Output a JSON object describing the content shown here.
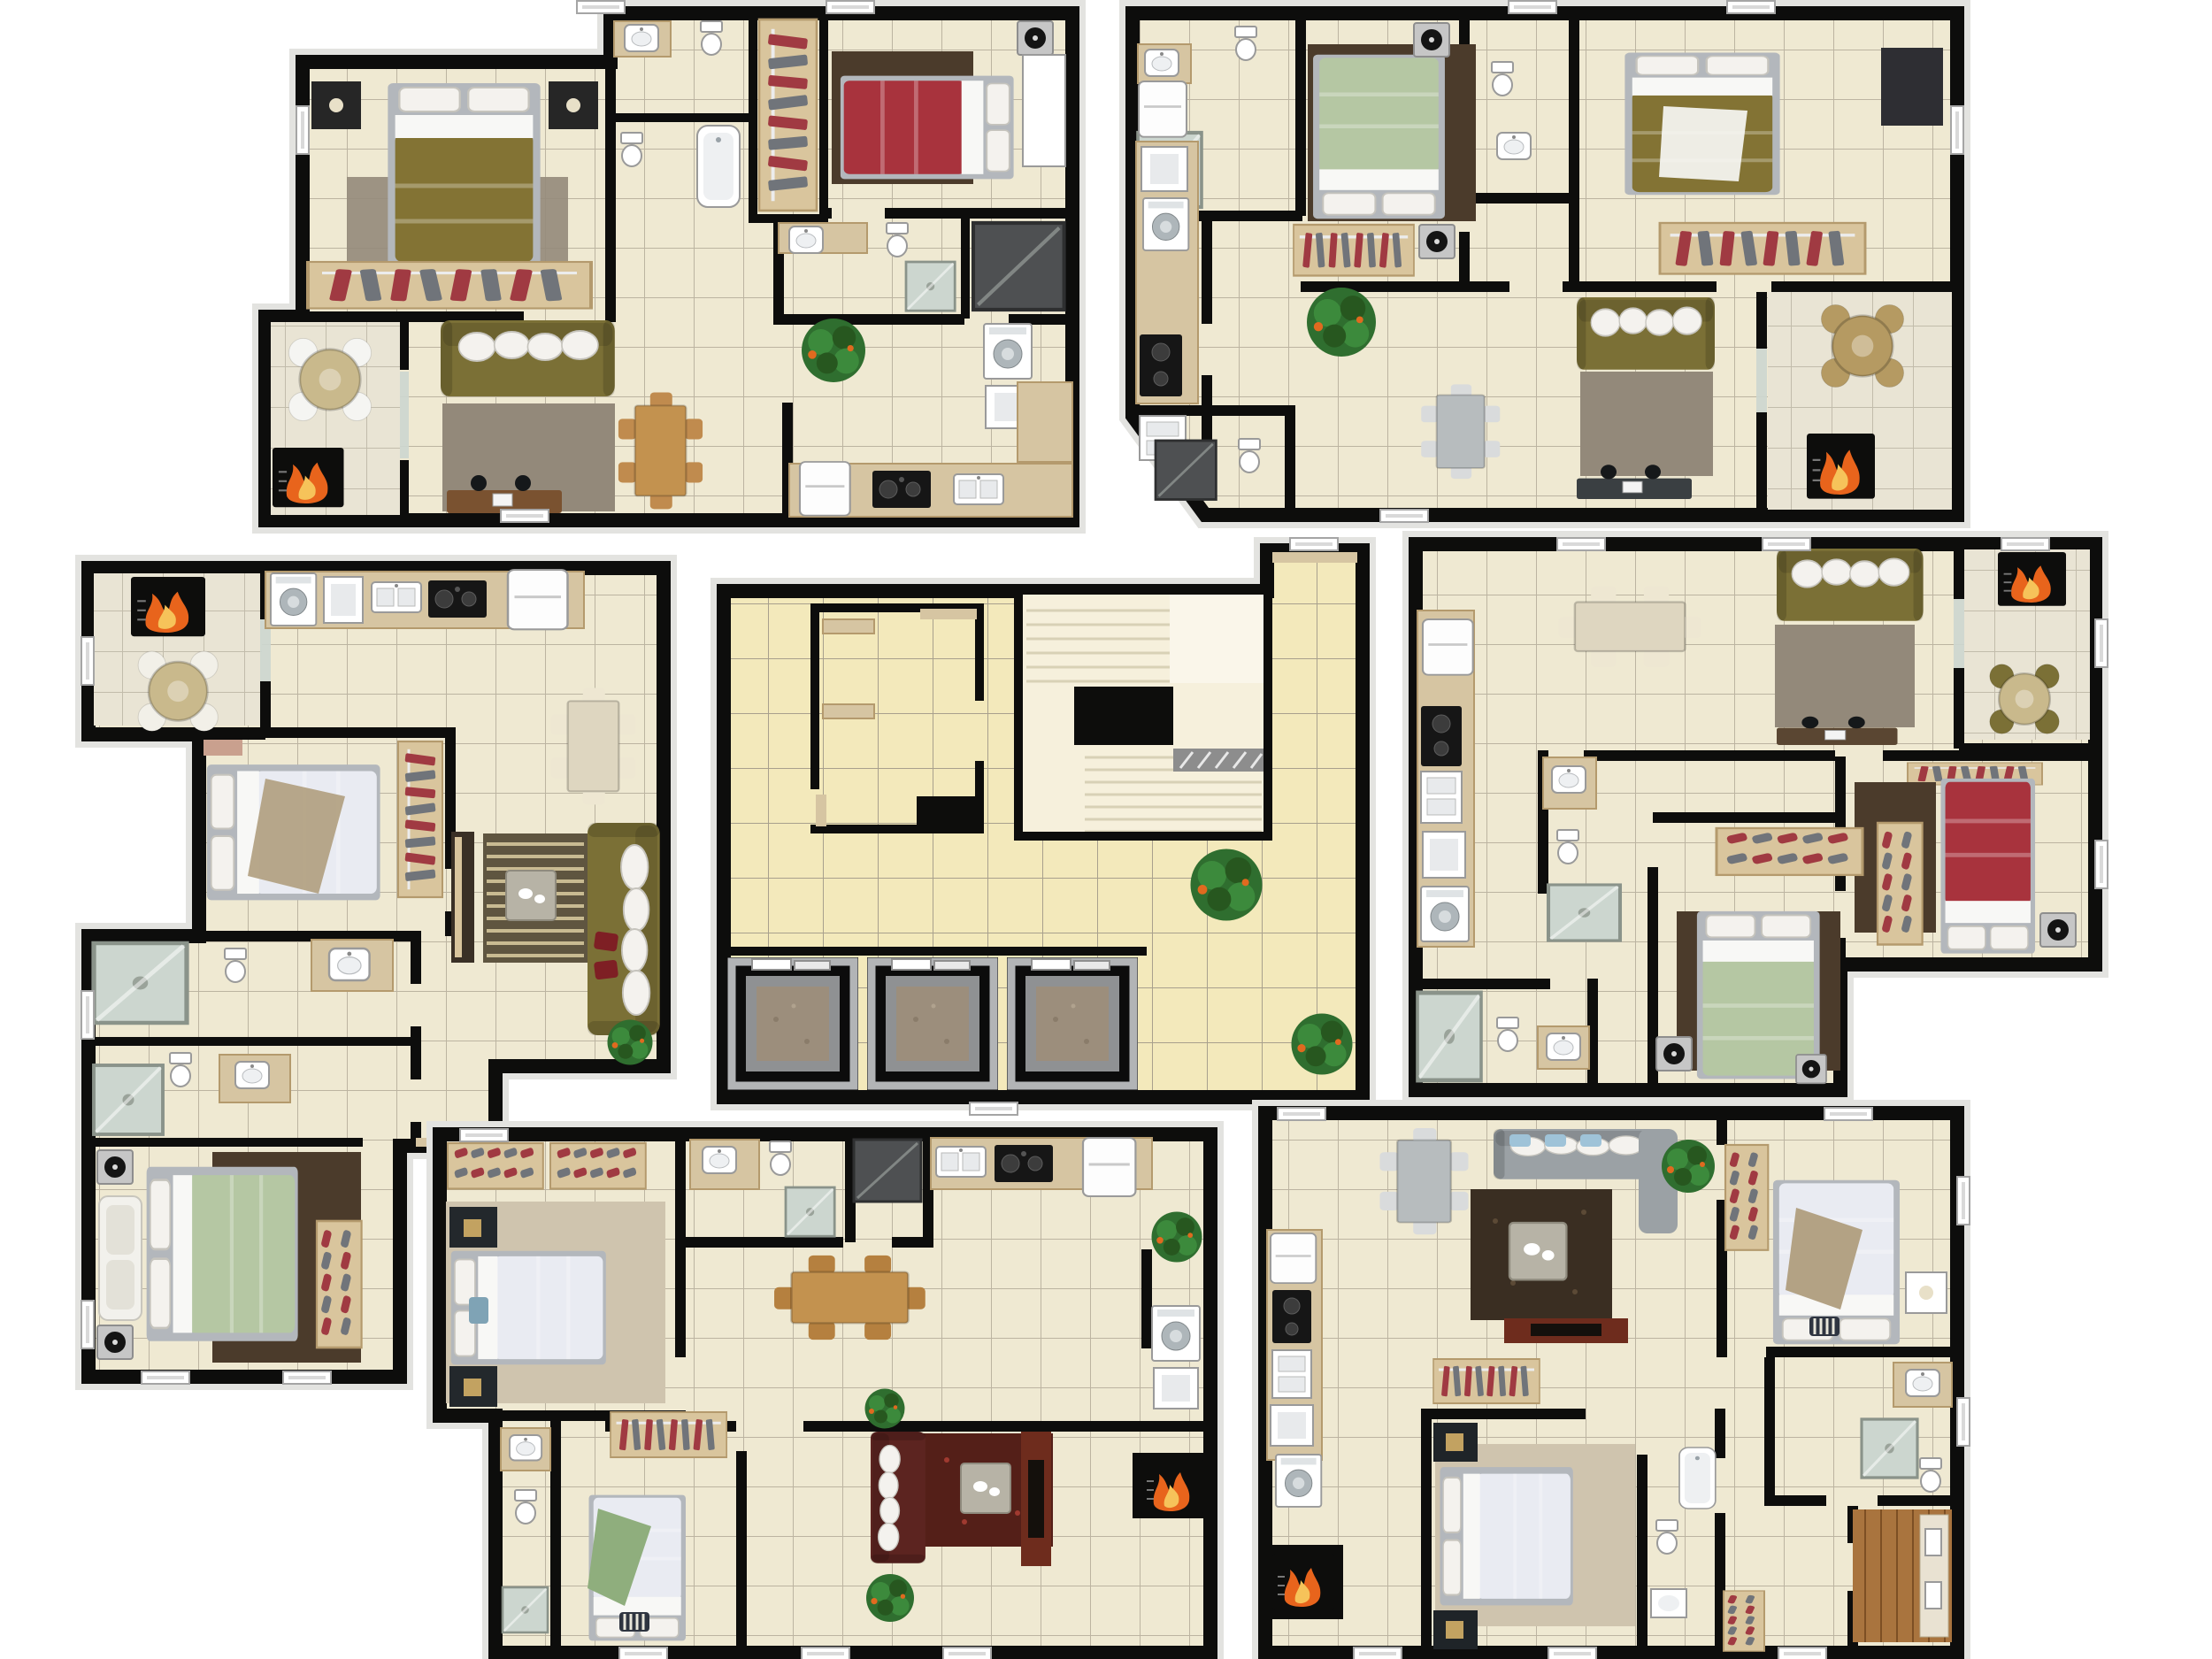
{
  "meta": {
    "kind": "3d-rendered-apartment-floor-plans",
    "units_count": 6,
    "elevator_count": 3,
    "background": "#ffffff"
  },
  "palette": {
    "wall": "#0d0d0c",
    "wall_trim": "#e3e3e0",
    "floor": "#efe9d2",
    "grout": "#bcb4a1",
    "floor_hall": "#f3e9bb",
    "grout_hall": "#a8a08d",
    "floor_balcony": "#e9e4d4",
    "grout_balcony": "#c2bcab",
    "counter": "#d6c5a2",
    "counter_edge": "#b49a6d",
    "closet_wood": "#d9c59d",
    "wood": "#c3924f",
    "wood_dark": "#7a5230",
    "cream": "#ded6c0",
    "table_gray": "#b7bcbe",
    "bed_olive": "#837334",
    "bed_red": "#a8333d",
    "bed_green": "#b5c7a3",
    "bed_white": "#e9ebf2",
    "blanket_tan": "#b3a284",
    "blanket_green": "#8fae7d",
    "sofa_olive": "#7b7036",
    "sofa_darkred": "#5c2420",
    "sofa_gray": "#9ba1a5",
    "pillow_blue": "#9fc3d8",
    "rug_gray": "#93897a",
    "rug_brown": "#4b3b2b",
    "rug_darkbrown": "#3a2e22",
    "rug_red": "#541f18",
    "rug_tan": "#cfc4ae",
    "rug_stripe": "#5f5540",
    "rug_stripe_line": "#c9bb92",
    "plant": "#2f6e2f",
    "fruit": "#e06a1f",
    "fire": "#e8641c",
    "fire_glow": "#f6c35a",
    "glass": "#ccd6cf",
    "dark_stall": "#4e5052",
    "metal": "#8f9193",
    "elevator_frame": "#b2b4b6",
    "elevator_floor": "#9c8e7c",
    "stair": "#f6f0dc",
    "stair_line": "#d8d1b6",
    "clothes_red": "#a03a42",
    "clothes_gray": "#70747a",
    "tv_dark": "#6e2c1d",
    "appliance_black": "#161616",
    "office_wood": "#a9743e",
    "office_wood_line": "#7d4f24"
  },
  "units": [
    {
      "id": "unit-top-left",
      "position": "top-left",
      "rooms": [
        "master-bedroom",
        "second-bedroom",
        "bathroom",
        "ensuite-bathroom",
        "shower-room",
        "walk-in-closet",
        "kitchen-laundry",
        "living-dining-room",
        "barbecue-balcony"
      ],
      "furniture": [
        "olive-double-bed",
        "red-double-bed",
        "wardrobe-racks",
        "nightstands",
        "speaker",
        "white-armoire",
        "olive-sofa",
        "gray-rug",
        "brown-rug",
        "wood-dining-table-six-chairs",
        "study-desk",
        "round-patio-table",
        "barbecue-grill-fire",
        "washing-machine",
        "laundry-tub",
        "refrigerator",
        "cooktop",
        "kitchen-sink",
        "toilets",
        "bathtub",
        "showers",
        "potted-plant"
      ]
    },
    {
      "id": "unit-top-right",
      "position": "top-right",
      "rooms": [
        "bedroom-green",
        "bedroom-olive",
        "bathroom",
        "half-bathroom",
        "corner-washroom",
        "kitchen",
        "living-dining-room",
        "barbecue-balcony"
      ],
      "furniture": [
        "green-double-bed",
        "olive-double-bed",
        "speakers",
        "clothes-racks",
        "dark-dresser",
        "olive-sofa",
        "gray-rug",
        "brown-rug",
        "gray-dining-table-wire-chairs",
        "study-desk",
        "wicker-round-table",
        "barbecue-grill-fire",
        "refrigerator",
        "washing-machine",
        "cooktop",
        "kitchen-sink",
        "toilets",
        "shower",
        "shower-stall",
        "potted-plant"
      ]
    },
    {
      "id": "unit-middle-left",
      "position": "middle-left",
      "rooms": [
        "bedroom-white",
        "bedroom-green",
        "bathroom-upper",
        "bathroom-lower",
        "kitchen",
        "living-room",
        "dining-area",
        "barbecue-balcony",
        "hallway"
      ],
      "furniture": [
        "white-patterned-double-bed",
        "sage-double-bed",
        "tan-blanket",
        "loveseat",
        "speakers",
        "clothes-rack",
        "shoe-rack",
        "cream-dining-table-six-chairs",
        "olive-sofa-red-pillows",
        "striped-rug",
        "coffee-table",
        "tv-sideboard",
        "washing-machine",
        "refrigerator",
        "cooktop",
        "kitchen-sink",
        "toilets",
        "showers",
        "round-patio-table",
        "barbecue-grill-fire",
        "potted-plant"
      ]
    },
    {
      "id": "unit-middle-right",
      "position": "middle-right",
      "rooms": [
        "bedroom-red",
        "bedroom-green",
        "bathroom",
        "guest-bathroom",
        "kitchen",
        "living-room",
        "dining-area",
        "barbecue-balcony",
        "hallway"
      ],
      "furniture": [
        "red-double-bed",
        "sage-double-bed",
        "speakers",
        "shoe-shelf",
        "wine-rack",
        "wall-closet",
        "cream-dining-table-six-chairs",
        "olive-sofa",
        "gray-rug",
        "dark-rugs",
        "study-desk",
        "round-patio-table-olive-chairs",
        "barbecue-grill-fire",
        "refrigerator",
        "washing-machine",
        "cooktop",
        "kitchen-sink",
        "toilets",
        "showers"
      ]
    },
    {
      "id": "unit-bottom-middle",
      "position": "bottom-center",
      "rooms": [
        "bedroom-white",
        "bedroom-green-blanket",
        "bathroom",
        "ensuite-bathroom",
        "shower-stall-room",
        "kitchen",
        "laundry",
        "dining-area",
        "living-room",
        "hallway"
      ],
      "furniture": [
        "white-double-bed",
        "speckled-double-bed-green-blanket",
        "striped-pillows",
        "shoe-cabinets",
        "clothes-rack",
        "dark-nightstands",
        "tan-rug",
        "wood-dining-table-six-chairs",
        "dark-red-sofa",
        "dark-red-rug",
        "coffee-table",
        "tv-cabinet",
        "fireplace-fire",
        "washing-machine",
        "laundry-tub",
        "refrigerator",
        "cooktop",
        "kitchen-sink",
        "toilets",
        "showers",
        "potted-plants"
      ]
    },
    {
      "id": "unit-bottom-right",
      "position": "bottom-right",
      "rooms": [
        "bedroom-silver",
        "bedroom-white",
        "bathroom",
        "narrow-bathroom",
        "home-office",
        "kitchen",
        "living-room",
        "dining-area",
        "hallway"
      ],
      "furniture": [
        "silver-patterned-double-bed-tan-blanket",
        "white-double-bed",
        "striped-pillows",
        "shoe-racks",
        "clothes-rack",
        "gold-pattern-nightstands",
        "gray-sectional-sofa-blue-pillows",
        "shag-rug",
        "coffee-table",
        "red-brown-tv-cabinet",
        "gray-dining-table-wire-chairs",
        "wood-floor-office-desk-with-monitors",
        "barbecue-grill-fire",
        "washing-machine",
        "laundry-tub",
        "refrigerator",
        "cooktop",
        "kitchen-sink",
        "toilets",
        "shower",
        "bathtub",
        "potted-plant"
      ]
    }
  ],
  "core": {
    "id": "common-core",
    "features": [
      "tiled-hallway",
      "three-elevators",
      "switchback-staircase",
      "service-room-with-shelves",
      "potted-plants"
    ],
    "elevator_count": 3
  }
}
